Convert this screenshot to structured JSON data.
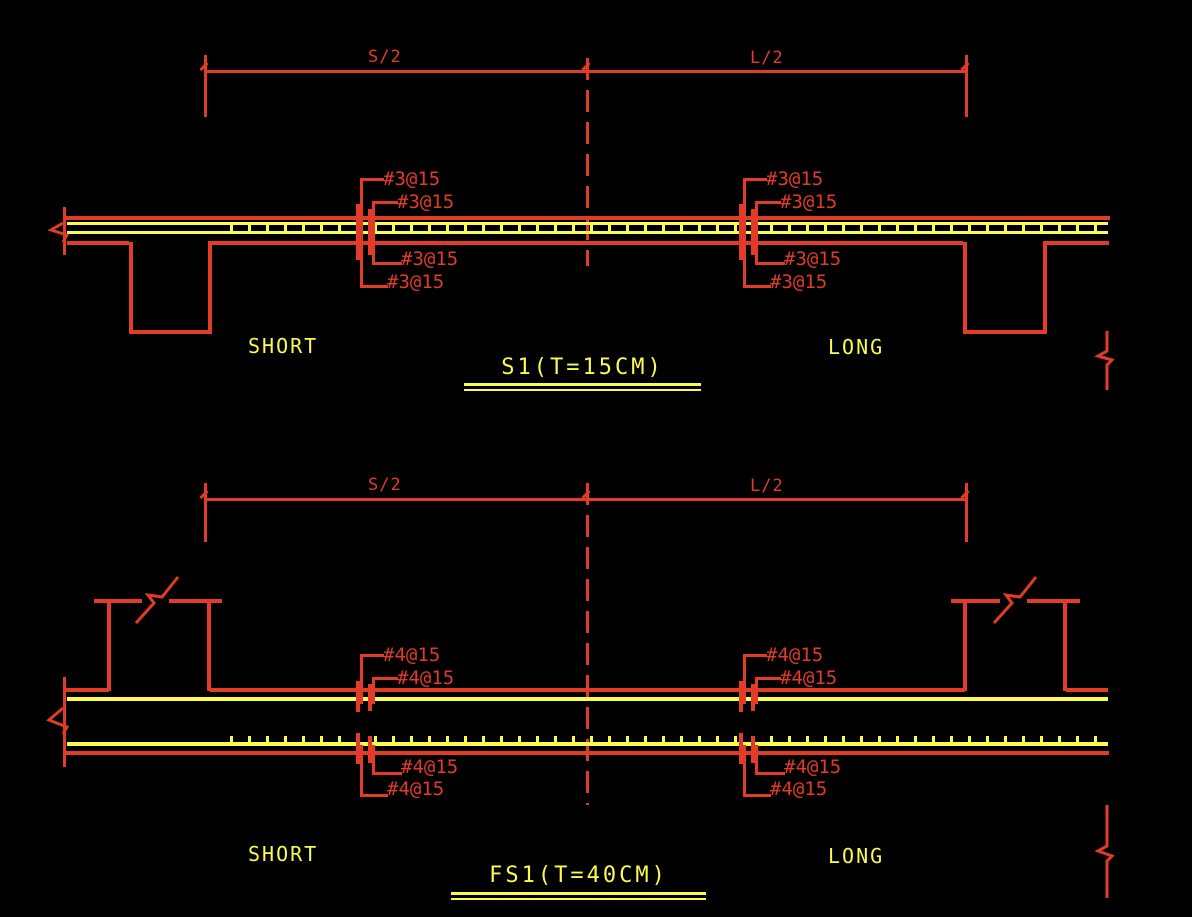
{
  "colors": {
    "red": "#e23b28",
    "yellow": "#fbfb4e",
    "background": "#000000"
  },
  "s1": {
    "dim_left": "S/2",
    "dim_right": "L/2",
    "region_short": "SHORT",
    "region_long": "LONG",
    "title": "S1(T=15CM)",
    "rebar_left": [
      "#3@15",
      "#3@15",
      "#3@15",
      "#3@15"
    ],
    "rebar_right": [
      "#3@15",
      "#3@15",
      "#3@15",
      "#3@15"
    ]
  },
  "fs1": {
    "dim_left": "S/2",
    "dim_right": "L/2",
    "region_short": "SHORT",
    "region_long": "LONG",
    "title": "FS1(T=40CM)",
    "rebar_left": [
      "#4@15",
      "#4@15",
      "#4@15",
      "#4@15"
    ],
    "rebar_right": [
      "#4@15",
      "#4@15",
      "#4@15",
      "#4@15"
    ]
  }
}
